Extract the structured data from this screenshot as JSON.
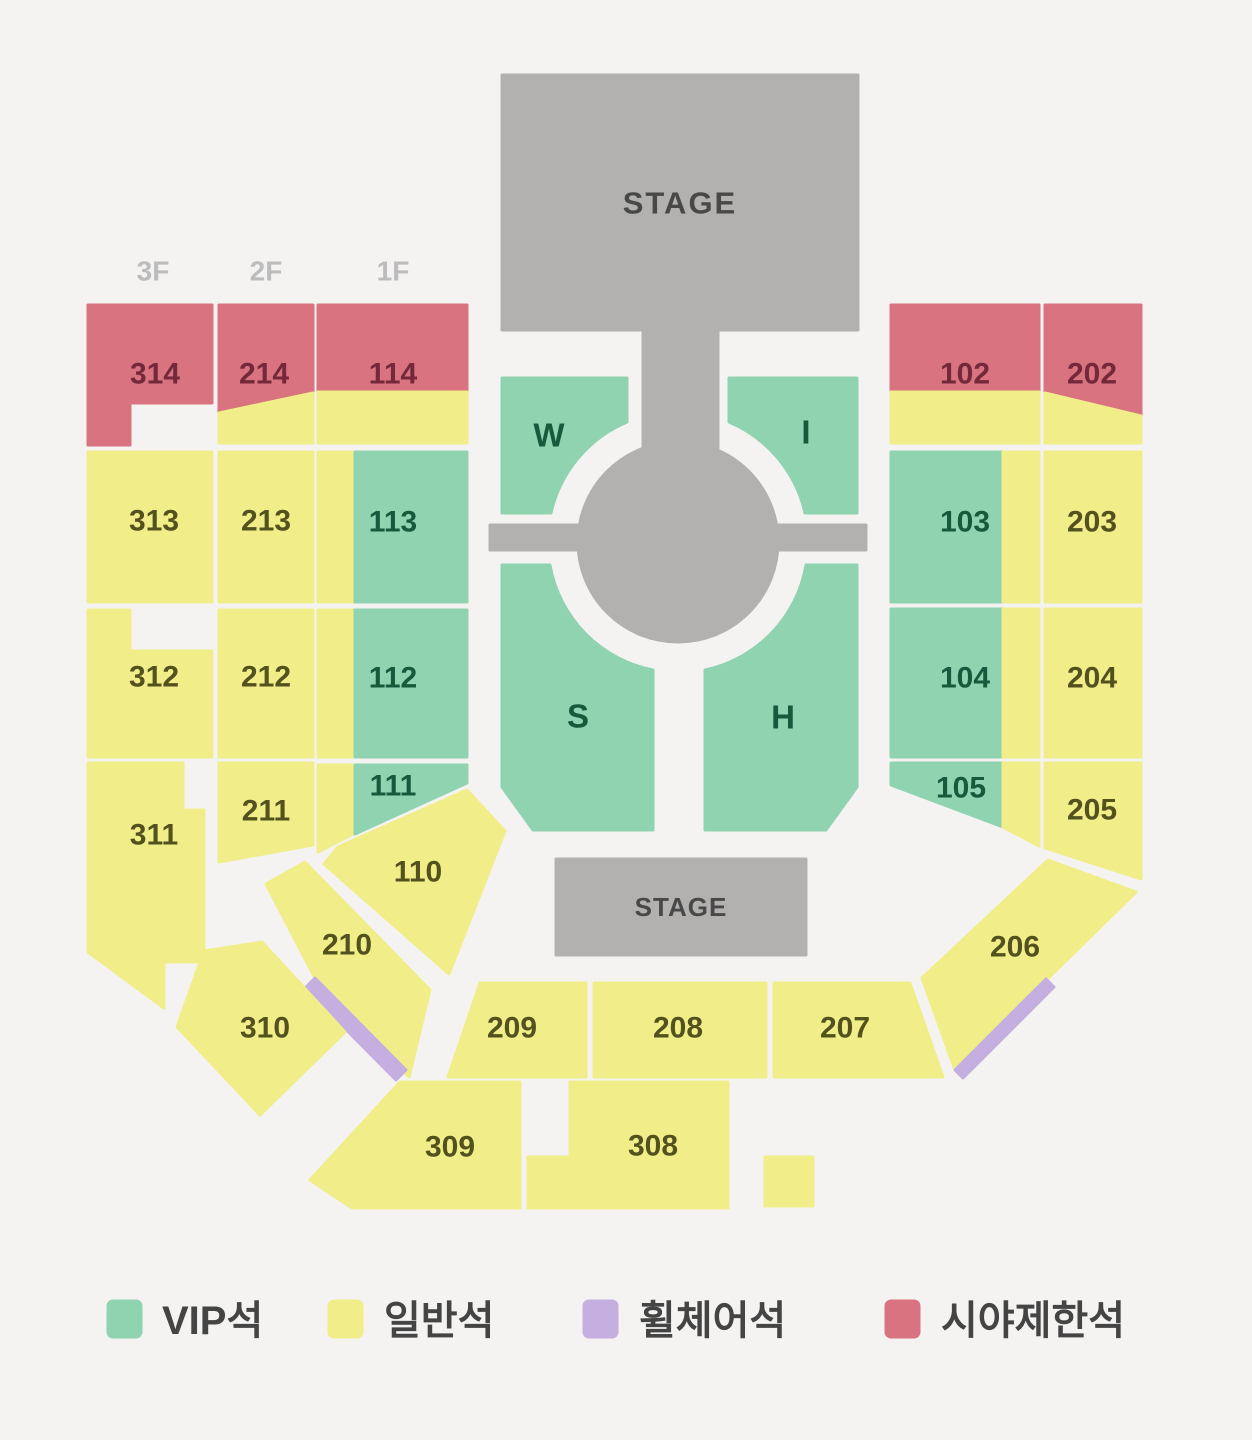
{
  "map": {
    "stage_top": "STAGE",
    "stage_bottom": "STAGE",
    "floors": [
      "3F",
      "2F",
      "1F"
    ],
    "sections": {
      "s314": {
        "label": "314",
        "type": "restricted"
      },
      "s214": {
        "label": "214",
        "type": "restricted+general"
      },
      "s114": {
        "label": "114",
        "type": "restricted+general"
      },
      "s102": {
        "label": "102",
        "type": "restricted+general"
      },
      "s202": {
        "label": "202",
        "type": "restricted+general"
      },
      "s313": {
        "label": "313",
        "type": "general"
      },
      "s213": {
        "label": "213",
        "type": "general"
      },
      "s113": {
        "label": "113",
        "type": "vip+general"
      },
      "s103": {
        "label": "103",
        "type": "vip+general"
      },
      "s203": {
        "label": "203",
        "type": "general"
      },
      "s312": {
        "label": "312",
        "type": "general"
      },
      "s212": {
        "label": "212",
        "type": "general"
      },
      "s112": {
        "label": "112",
        "type": "vip+general"
      },
      "s104": {
        "label": "104",
        "type": "vip+general"
      },
      "s204": {
        "label": "204",
        "type": "general"
      },
      "s311": {
        "label": "311",
        "type": "general"
      },
      "s211": {
        "label": "211",
        "type": "general"
      },
      "s111": {
        "label": "111",
        "type": "vip+general"
      },
      "s105": {
        "label": "105",
        "type": "vip+general"
      },
      "s205": {
        "label": "205",
        "type": "general"
      },
      "s110": {
        "label": "110",
        "type": "general"
      },
      "s210": {
        "label": "210",
        "type": "general+wheelchair"
      },
      "s206": {
        "label": "206",
        "type": "general+wheelchair"
      },
      "s310": {
        "label": "310",
        "type": "general"
      },
      "s209": {
        "label": "209",
        "type": "general"
      },
      "s208": {
        "label": "208",
        "type": "general"
      },
      "s207": {
        "label": "207",
        "type": "general"
      },
      "s309": {
        "label": "309",
        "type": "general"
      },
      "s308": {
        "label": "308",
        "type": "general"
      },
      "sW": {
        "label": "W",
        "type": "vip"
      },
      "sI": {
        "label": "I",
        "type": "vip"
      },
      "sS": {
        "label": "S",
        "type": "vip"
      },
      "sH": {
        "label": "H",
        "type": "vip"
      }
    }
  },
  "legend": {
    "items": [
      {
        "label": "VIP석",
        "key": "vip"
      },
      {
        "label": "일반석",
        "key": "general"
      },
      {
        "label": "휠체어석",
        "key": "wheelchair"
      },
      {
        "label": "시야제한석",
        "key": "restricted"
      }
    ]
  },
  "colors": {
    "vip": "#90d3b0",
    "general": "#f1ee8a",
    "wheelchair": "#c5aee0",
    "restricted": "#d8737f",
    "stage": "#b2b1b0",
    "bg": "#f4f3f1",
    "label_yellow": "#53511d",
    "label_green": "#17593c",
    "label_red": "#73293a",
    "label_gray": "#bcbcbc",
    "stage_text": "#484848",
    "legend_text": "#444444"
  }
}
